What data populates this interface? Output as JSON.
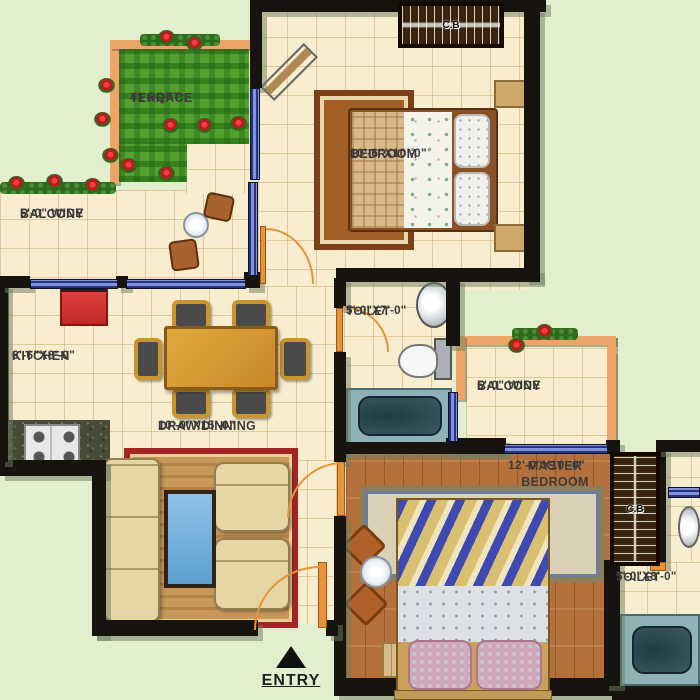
{
  "plan": {
    "entry": {
      "label": "ENTRY"
    },
    "cupboard_label": "C.B",
    "rooms": {
      "terrace": {
        "name": "TERRACE",
        "dims": "41 SQFT."
      },
      "balcony_top": {
        "name": "BALCONY",
        "dims": "5'-0\" WIDE"
      },
      "bedroom": {
        "name": "BEDROOM",
        "dims": "10'-6\"X10'-0\""
      },
      "toilet_top": {
        "name": "TOILET",
        "dims": "5'-0\"X7'-0\""
      },
      "kitchen": {
        "name": "KITCHEN",
        "dims": "6'-6\"X8'-0\""
      },
      "draw_dining": {
        "name": "DRAW/DINNING",
        "dims": "10'-0\"X15'-0\""
      },
      "balcony_right": {
        "name": "BALCONY",
        "dims": "5'-0\" WIDE"
      },
      "master_bedroom": {
        "name": "MASTER BEDROOM",
        "dims": "12'-0\"X10'-0\""
      },
      "toilet_bottom": {
        "name": "TOILET",
        "dims": "5'-0\"X8'-0\""
      }
    },
    "colors": {
      "background": "#e2efcf",
      "wall": "#17130e",
      "terrace_grass": "#54a130",
      "floor_tile": "#f8edcf",
      "wood_floor": "#b4713c",
      "window_blue": "#8292dd",
      "railing_orange": "#eda467",
      "accent_red": "#d63030"
    }
  }
}
